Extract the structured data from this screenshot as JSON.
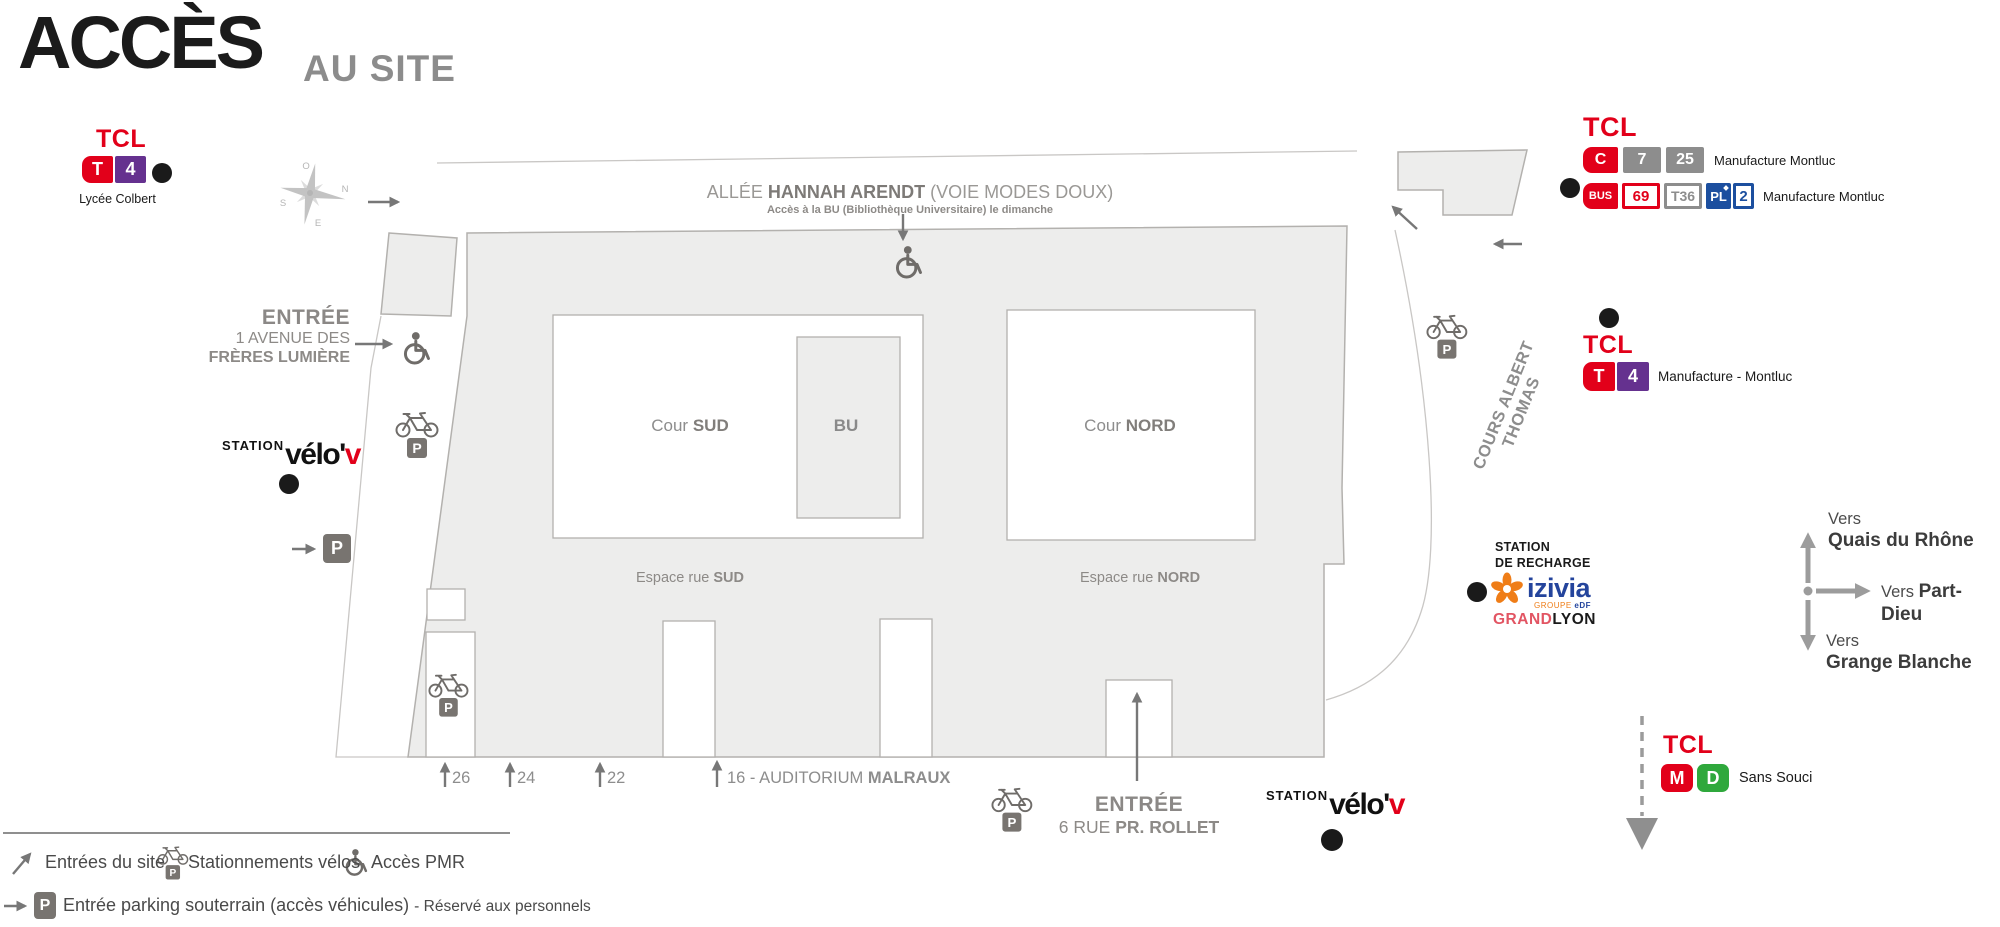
{
  "title": {
    "main": "ACCÈS",
    "sub": "AU SITE"
  },
  "tcl_colbert": {
    "brand": "TCL",
    "badge_t": "T",
    "badge_4": "4",
    "station": "Lycée Colbert"
  },
  "tcl_montluc": {
    "brand": "TCL",
    "row1_b1": "C",
    "row1_b2": "7",
    "row1_b3": "25",
    "row1_label": "Manufacture Montluc",
    "row2_b1": "BUS",
    "row2_b2": "69",
    "row2_b3": "T36",
    "row2_b4": "PL",
    "row2_b5": "2",
    "row2_label": "Manufacture Montluc"
  },
  "tcl_t4_right": {
    "brand": "TCL",
    "badge_t": "T",
    "badge_4": "4",
    "label": "Manufacture - Montluc"
  },
  "tcl_sans_souci": {
    "brand": "TCL",
    "badge_m": "M",
    "badge_d": "D",
    "label": "Sans Souci"
  },
  "allee": {
    "pre": "ALLÉE ",
    "name": "HANNAH ARENDT",
    "post": " (VOIE MODES DOUX)",
    "note": "Accès à la BU (Bibliothèque Universitaire) le dimanche"
  },
  "streets": {
    "cours": "COURS ALBERT THOMAS"
  },
  "areas": {
    "cour_sud_pre": "Cour ",
    "cour_sud": "SUD",
    "bu": "BU",
    "cour_nord_pre": "Cour ",
    "cour_nord": "NORD",
    "espace_sud_pre": "Espace rue ",
    "espace_sud": "SUD",
    "espace_nord_pre": "Espace rue ",
    "espace_nord": "NORD"
  },
  "entrances": {
    "lumiere_title": "ENTRÉE",
    "lumiere_l1": "1 AVENUE DES",
    "lumiere_l2": "FRÈRES LUMIÈRE",
    "rollet_title": "ENTRÉE",
    "rollet_pre": "6 RUE ",
    "rollet_bold": "PR. ROLLET"
  },
  "street_numbers": {
    "n26": "26",
    "n24": "24",
    "n22": "22",
    "n16_pre": "16 - AUDITORIUM ",
    "n16_bold": "MALRAUX"
  },
  "velov": {
    "station": "STATION",
    "name": "vélo'",
    "v": "v"
  },
  "recharge": {
    "l1": "STATION",
    "l2": "DE RECHARGE",
    "brand": "izivia",
    "group": "GROUPE",
    "edf": "eDF",
    "city_a": "GRAND",
    "city_b": "LYON"
  },
  "directions": {
    "north_pre": "Vers",
    "north": "Quais du Rhône",
    "east_pre": "Vers ",
    "east": "Part-Dieu",
    "south_pre": "Vers",
    "south": "Grange Blanche"
  },
  "legend": {
    "entries": "Entrées du site",
    "bikes": "Stationnements vélos",
    "pmr": "Accès PMR",
    "parking": "Entrée parking souterrain (accès véhicules) ",
    "parking_note": "- Réservé aux personnels"
  },
  "compass": {
    "n": "N",
    "s": "S",
    "e": "E",
    "o": "O"
  },
  "icons": {
    "p_badge": "P"
  },
  "colors": {
    "tcl_red": "#e2001a",
    "tram_purple": "#65318f",
    "metro_d_green": "#2fa83c",
    "badge_gray": "#8d8d8d",
    "pl_blue": "#1c4f9f",
    "izivia_blue": "#24449c",
    "izivia_orange": "#ef7d17",
    "grandlyon_red": "#e25563",
    "building_fill": "#ededec",
    "building_stroke": "#b3b1ae",
    "map_text_gray": "#8d8a87"
  }
}
